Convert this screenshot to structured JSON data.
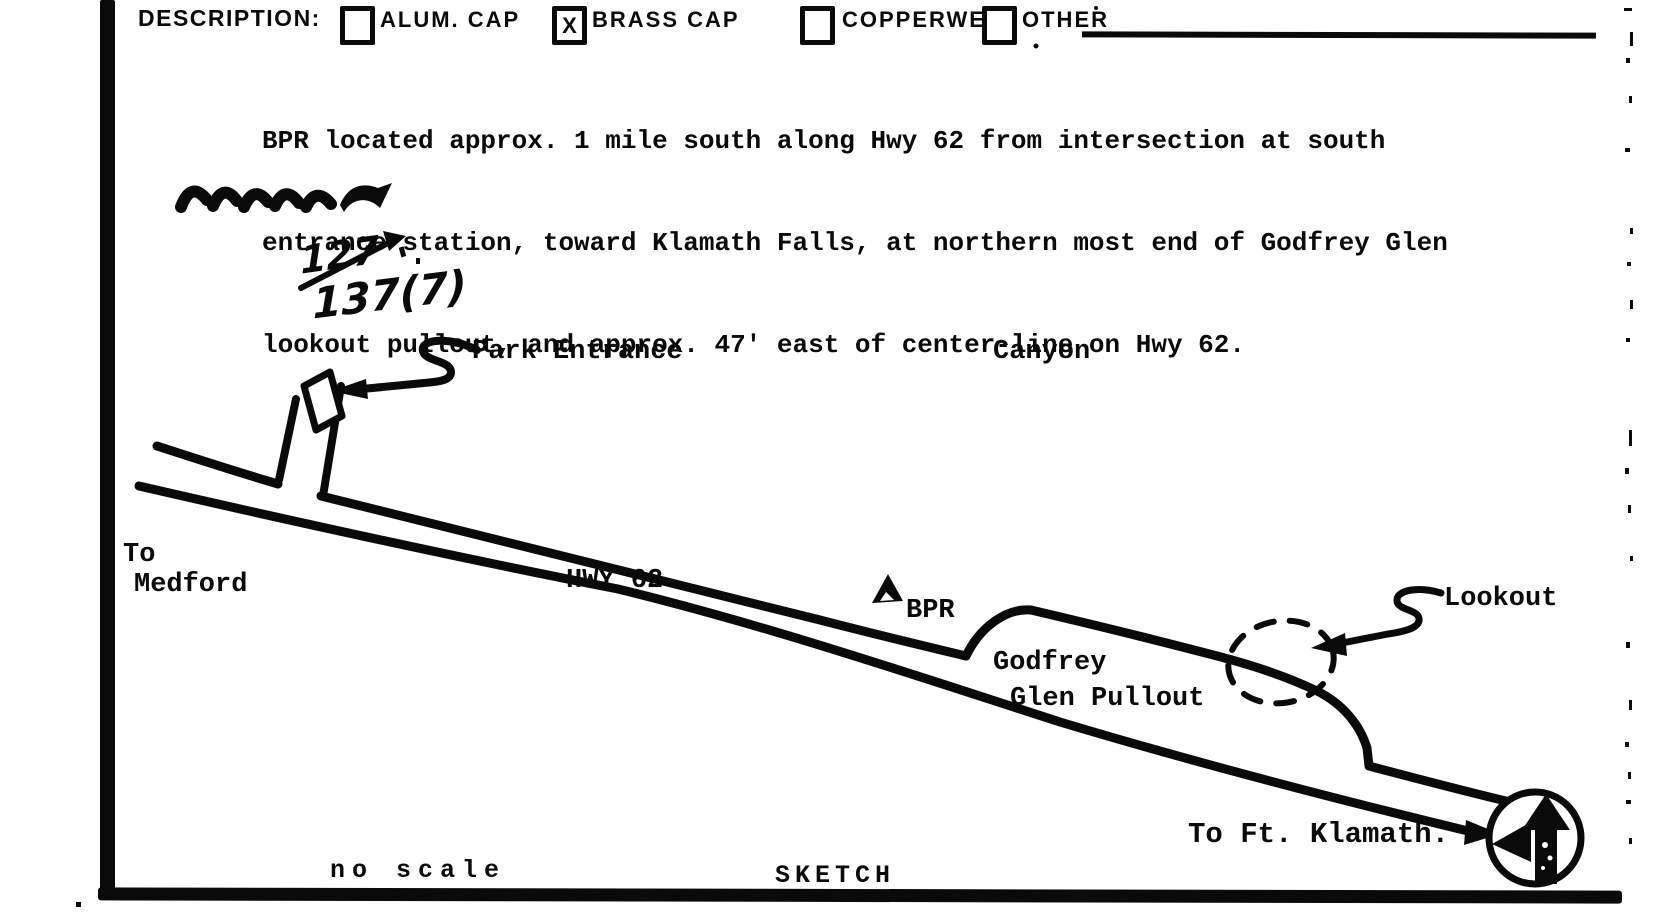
{
  "form": {
    "description_label": "DESCRIPTION:",
    "checkboxes": [
      {
        "label": "ALUM. CAP",
        "checked": false,
        "mark": ""
      },
      {
        "label": "BRASS CAP",
        "checked": true,
        "mark": "X"
      },
      {
        "label": "COPPERWELD",
        "checked": false,
        "mark": ""
      },
      {
        "label": "OTHER",
        "checked": false,
        "mark": ""
      }
    ],
    "other_value": "",
    "location_description": [
      "BPR located approx. 1 mile south along Hwy 62 from intersection at south",
      "entrance station, toward Klamath Falls, at northern most end of Godfrey Glen",
      "lookout pullout, and approx. 47' east of center-line on Hwy 62."
    ]
  },
  "annotations": {
    "struck_value": "127",
    "revised_value": "137(7)"
  },
  "sketch": {
    "labels": {
      "park_entrance": "Park Entrance",
      "canyon": "Canyon",
      "to_medford_line1": "To",
      "to_medford_line2": "Medford",
      "hwy": "HWY 62",
      "bpr": "BPR",
      "pullout_line1": "Godfrey",
      "pullout_line2": "Glen Pullout",
      "lookout": "Lookout",
      "to_ft_klamath": "To Ft. Klamath.",
      "no_scale": "no scale",
      "title": "SKETCH"
    },
    "ink_color": "#0a0a0a"
  }
}
